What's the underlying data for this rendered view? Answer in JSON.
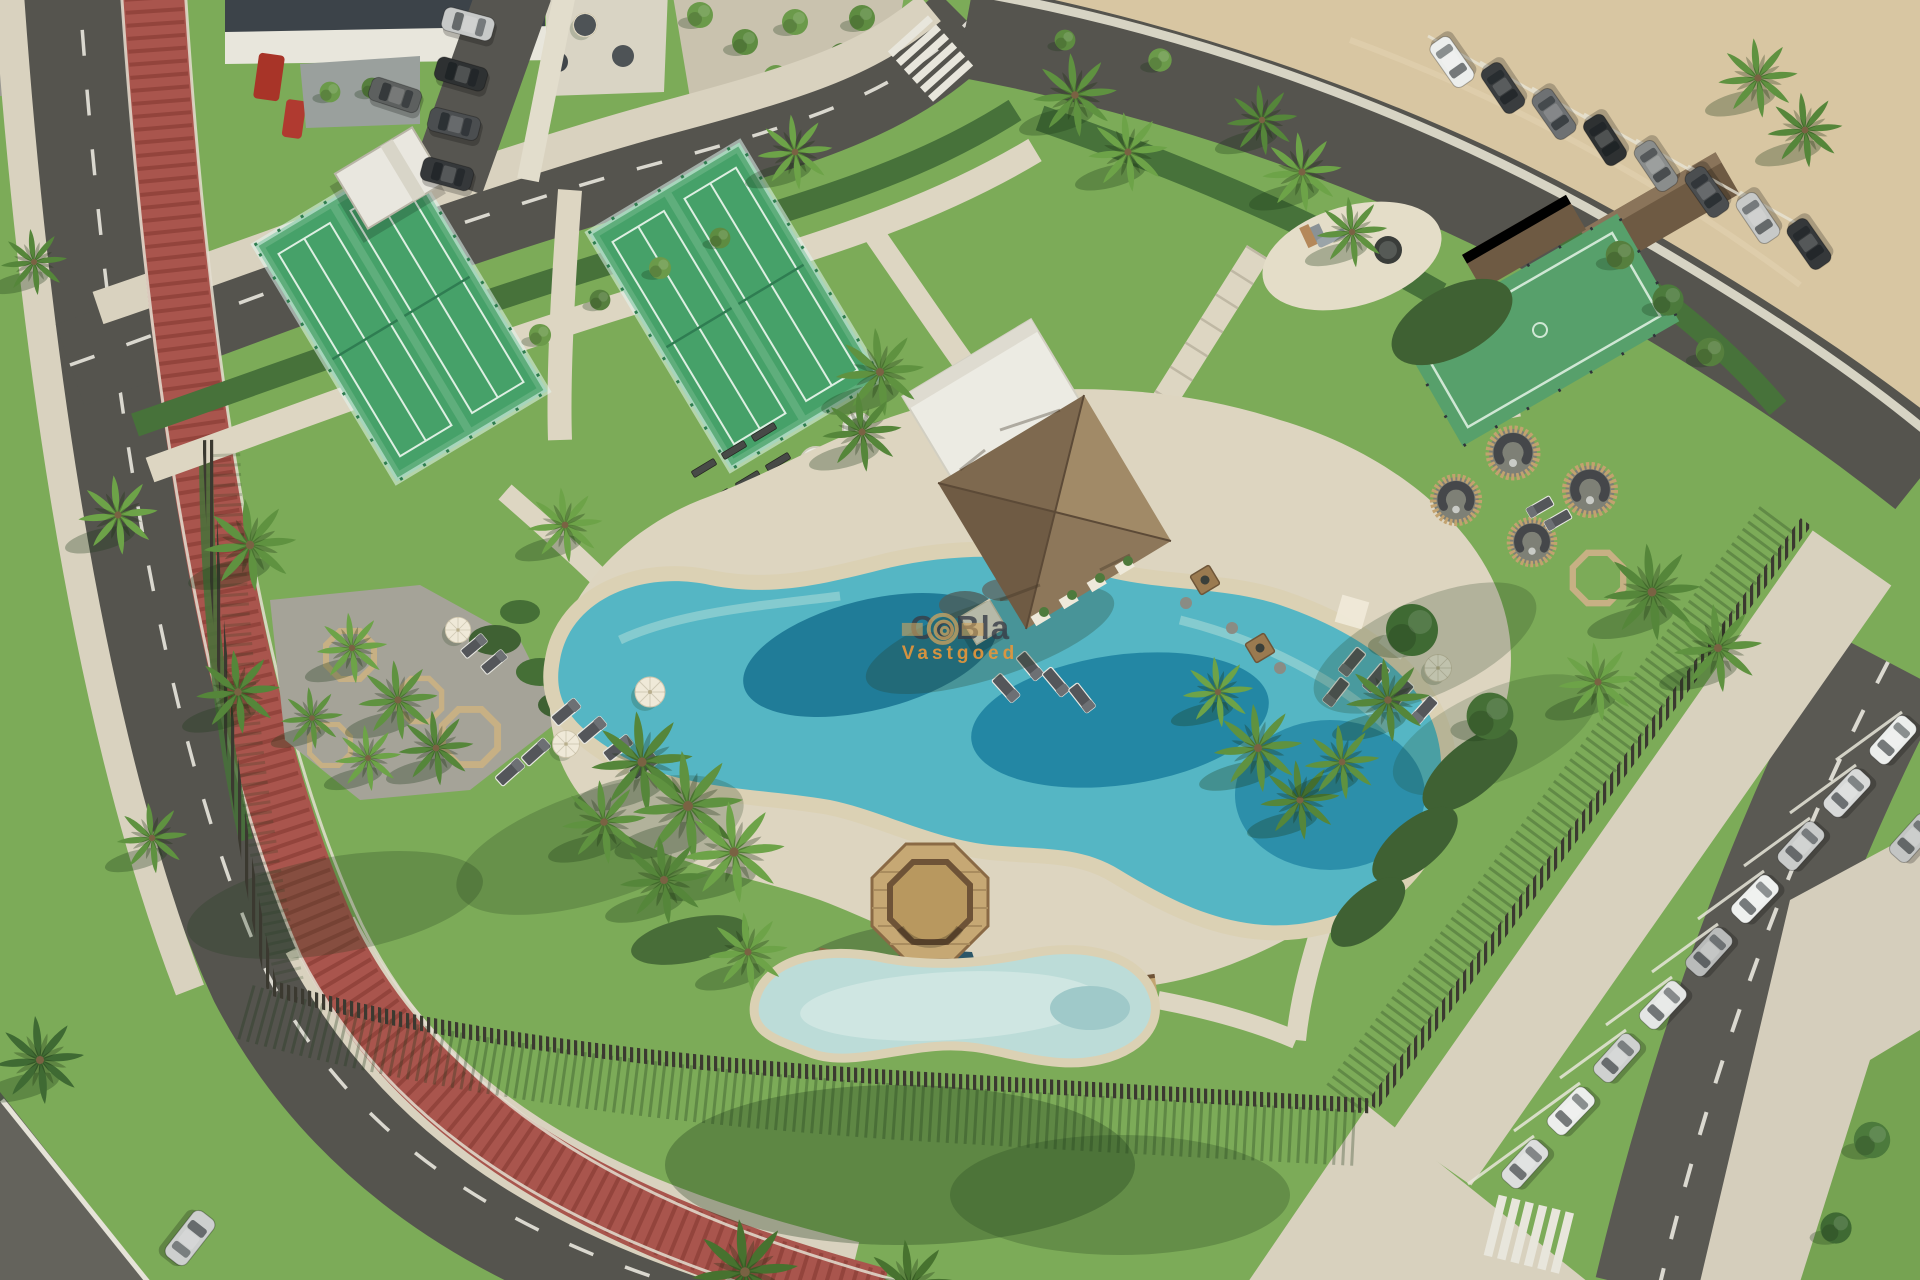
{
  "watermark": {
    "brand": "CoBla",
    "subtitle": "Vastgoed",
    "logo": "gold-spiral-sun-logo",
    "colors": {
      "brand": "#3b4148",
      "subtitle": "#e4963c",
      "logo": "#d2a55e"
    }
  },
  "scene": {
    "type": "aerial-photo-render",
    "setting": "coastal-resort-amenity-park",
    "palette": {
      "grass": "#7cab58",
      "grass_shadow": "#3f6b33",
      "asphalt": "#55544e",
      "bike_lane_red": "#a9554d",
      "sidewalk": "#d9d2bf",
      "sand": "#d8c6a2",
      "pool_deep": "#17718f",
      "pool_mid": "#2f9fba",
      "pool_rim": "#a7dad8",
      "beach_sand": "#dbd1b4",
      "kids_pool": "#bcdcd8",
      "court_green": "#46a169",
      "thatch_roof": "#8a7356",
      "wood_deck": "#c3a571",
      "fence_timber": "#3b3930",
      "hedge": "#47723a",
      "palm": "#5f9240",
      "car_white": "#eceeec",
      "car_dark": "#3a3d3f",
      "red_vehicle": "#b03a30"
    },
    "features": [
      "perimeter-road",
      "red-bike-lane",
      "street-parking-dark-cars",
      "cafe-terrace-building",
      "tree-grove-plaza",
      "pedestrian-crosswalks",
      "sandy-lot",
      "padel-court-pair-west",
      "padel-court-pair-center",
      "padel-hut",
      "thatched-pavilion",
      "olive-tree-planters",
      "garden-benches",
      "fitness-circles",
      "gravel-picnic-octagons",
      "playground-oval",
      "multisport-mini-pitch",
      "wicker-seating-pods",
      "lagoon-pool",
      "beach-entry",
      "sun-loungers",
      "parasols",
      "shade-sails",
      "wooden-gazebo",
      "foot-bridges",
      "kids-pool",
      "water-channel",
      "slatted-timber-fence",
      "angled-parking-white-cars",
      "promenade-walk",
      "palm-trees",
      "hedges",
      "lawns"
    ]
  }
}
